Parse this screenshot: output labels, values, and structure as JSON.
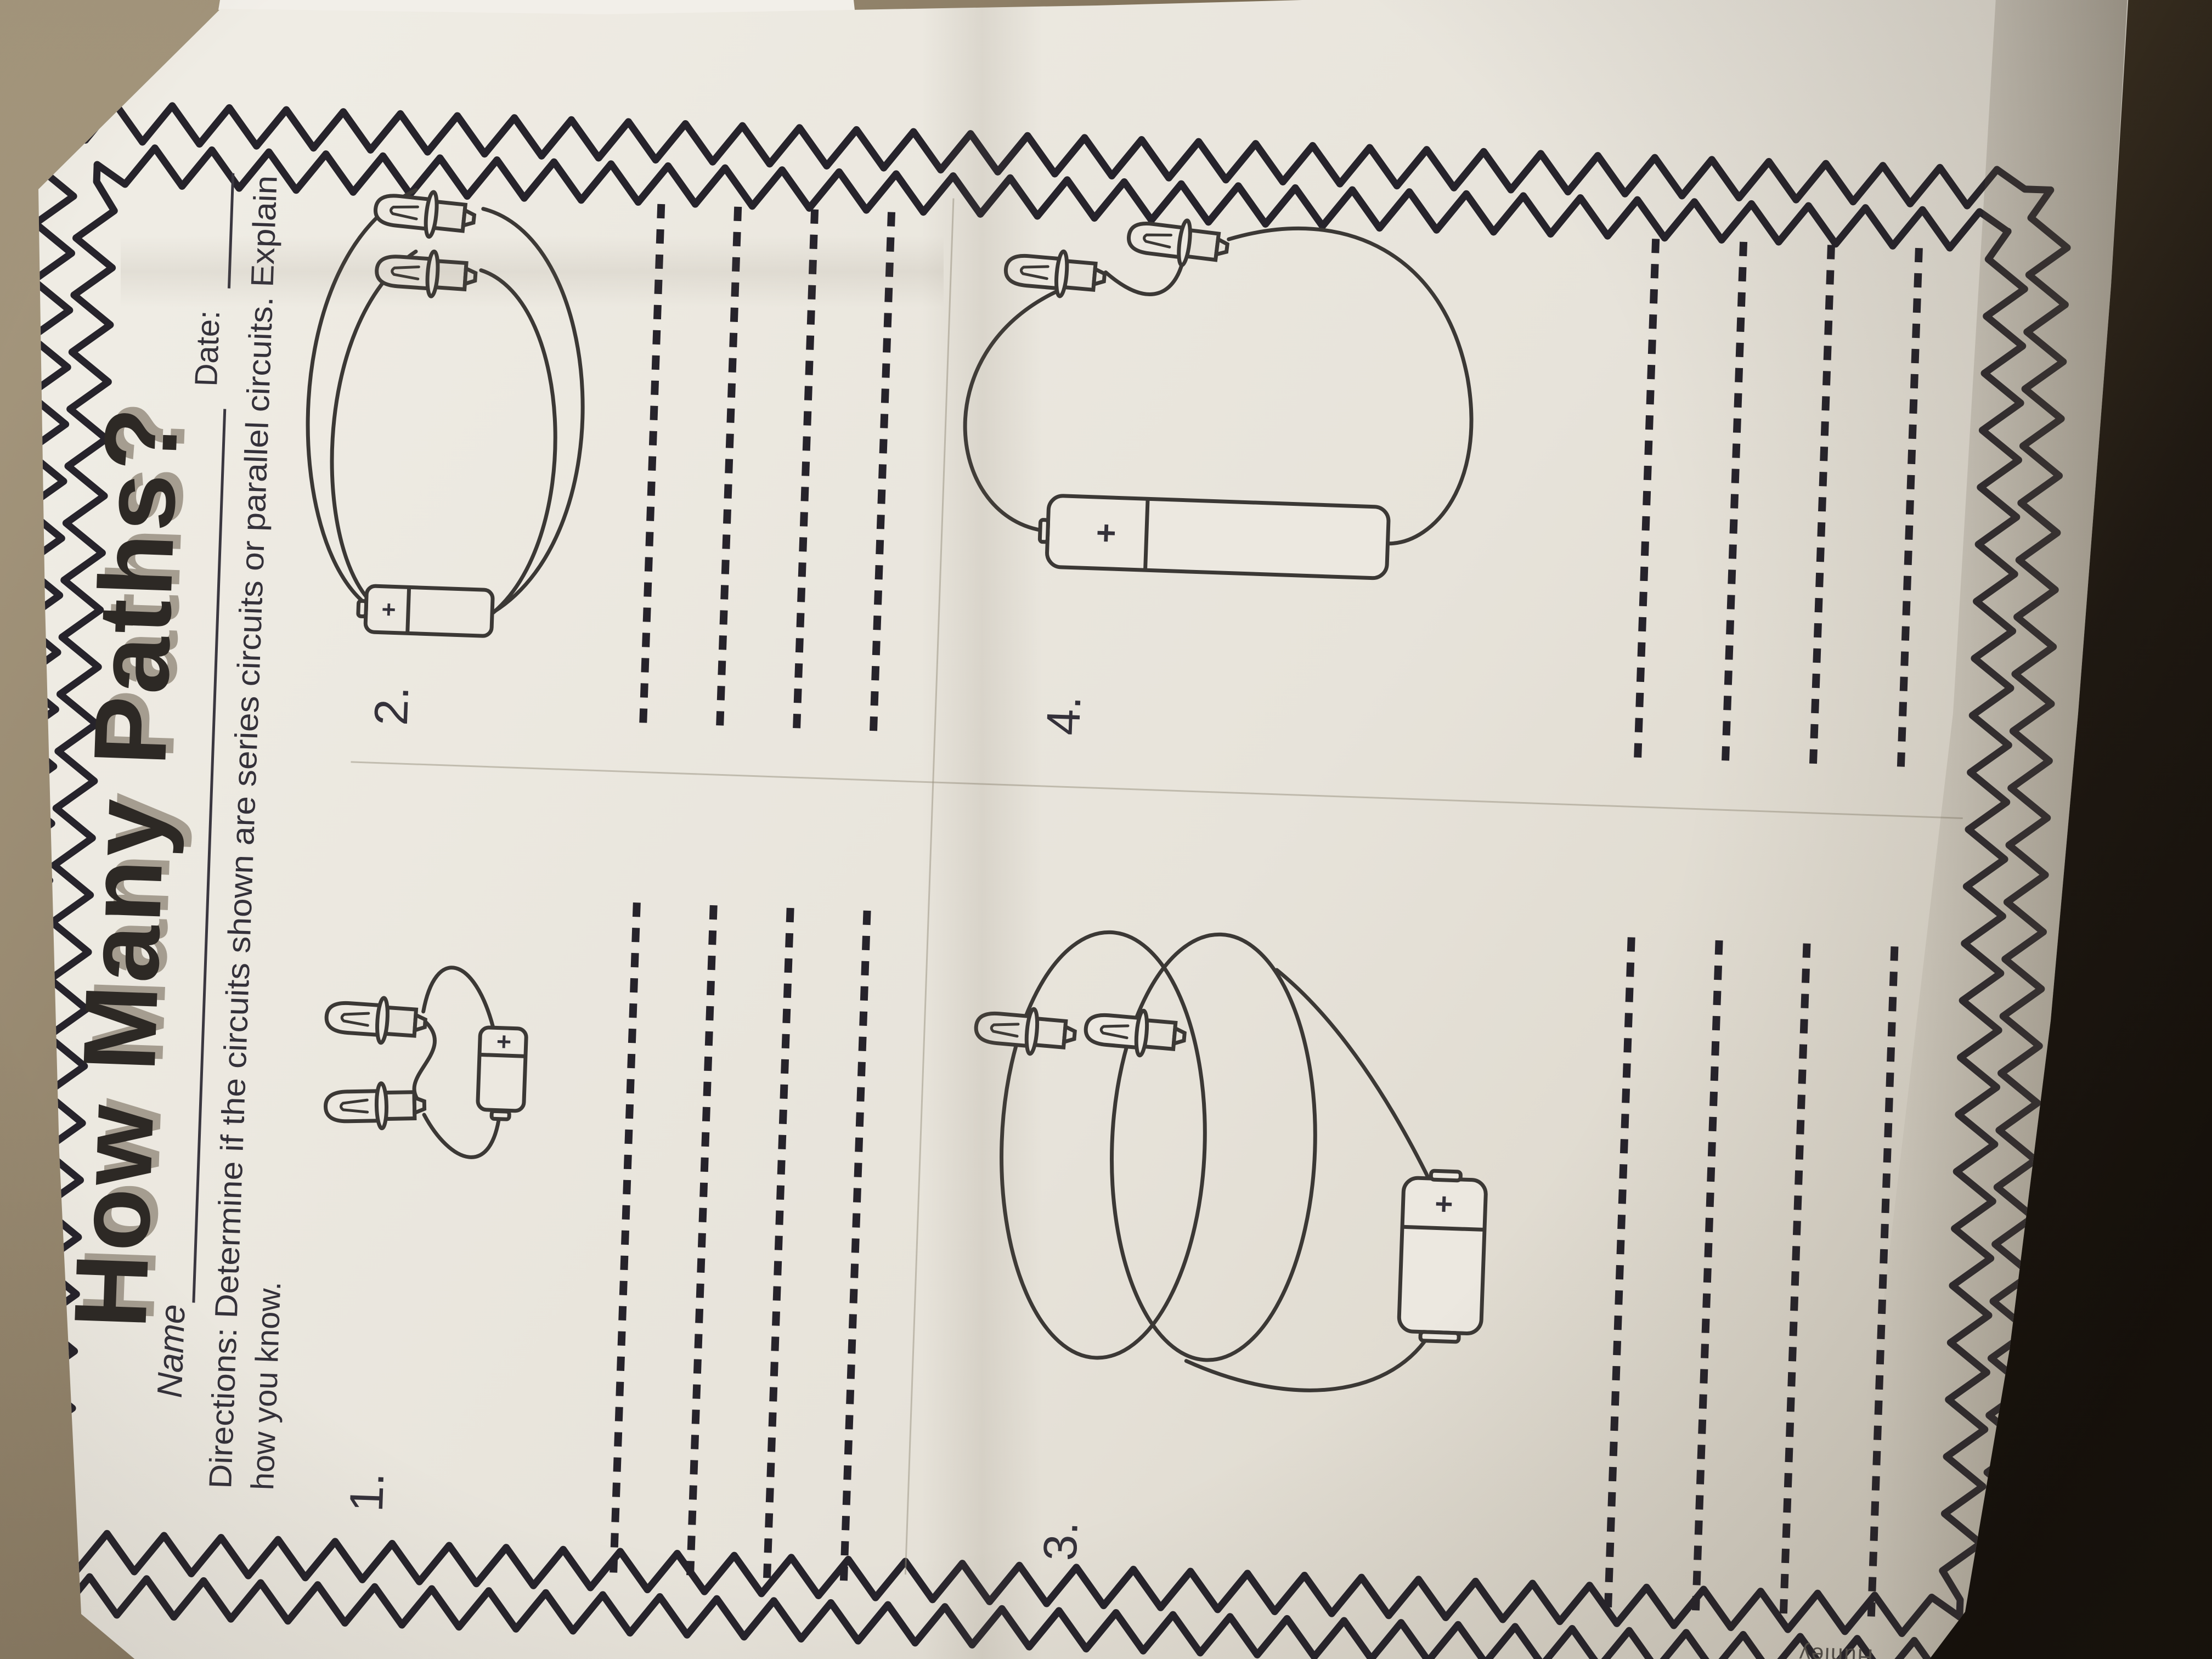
{
  "worksheet": {
    "title": "How Many Paths?",
    "name_label": "Name",
    "date_label": "Date:",
    "directions": {
      "line1": "Directions: Determine if the circuits shown are series circuits or parallel circuits. Explain",
      "line2": "how you know."
    },
    "battery_plus": "+",
    "questions": [
      {
        "number": "1.",
        "diagram": "battery-with-two-bulbs-series",
        "answer_lines": 4
      },
      {
        "number": "2.",
        "diagram": "battery-with-two-bulbs-parallel",
        "answer_lines": 4
      },
      {
        "number": "3.",
        "diagram": "battery-with-two-bulbs-parallel-loops",
        "answer_lines": 4
      },
      {
        "number": "4.",
        "diagram": "battery-with-two-bulbs-series-loop",
        "answer_lines": 4
      }
    ],
    "credit_fragment": "Hunley"
  },
  "colors": {
    "ink": "#2b2830",
    "paper": "#e9e5dc",
    "floor_light": "#a3947a",
    "floor_dark": "#140f09"
  }
}
